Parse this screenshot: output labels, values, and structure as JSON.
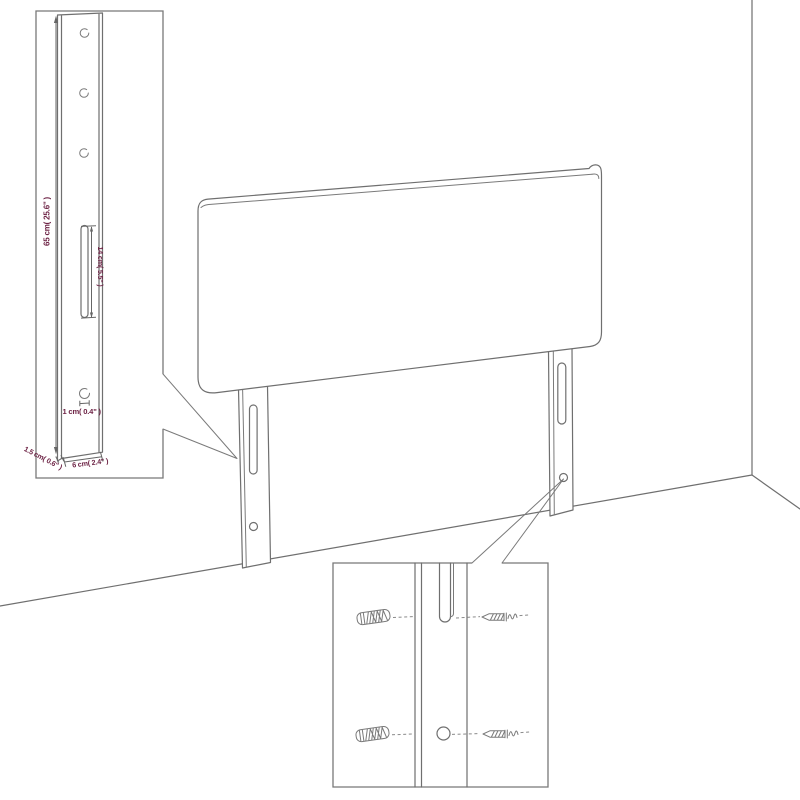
{
  "colors": {
    "background": "#ffffff",
    "drawing_line": "#6f6f6f",
    "dimension_text": "#6d2345",
    "dashed_line": "#8a8a8a"
  },
  "insets": {
    "leg_detail": {
      "dim_height": "65 cm( 25.6\" )",
      "dim_slot_length": "14 cm( 5.5\" )",
      "dim_hole_diameter": "1 cm( 0.4\" )",
      "dim_depth": "1.5 cm( 0.6\" )",
      "dim_width": "6 cm( 2.4\" )"
    }
  }
}
